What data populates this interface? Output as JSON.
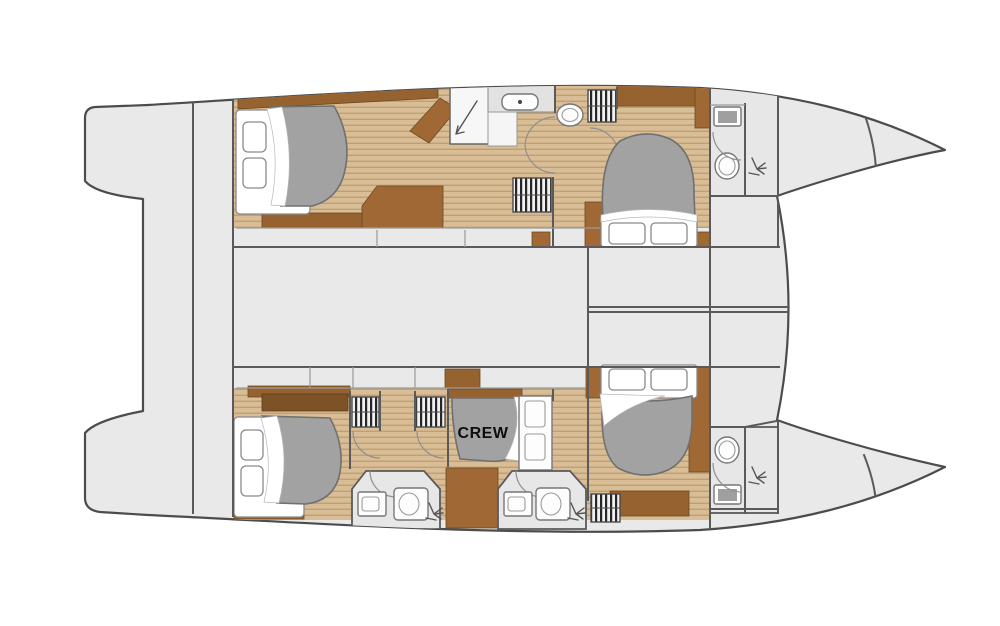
{
  "diagram": {
    "kind": "catamaran-yacht-deck-plan",
    "labels": {
      "crew_cabin": "CREW"
    },
    "colors": {
      "deck_fill": "#e9e9e9",
      "hull_outline": "#4c4c4c",
      "wall": "#5a5a5a",
      "wall_light": "#9a9a9a",
      "teak_base": "#d9bd96",
      "teak_stripe": "#c09f72",
      "wood_brown": "#a06835",
      "wood_brown_dark": "#7e5227",
      "wood_brown_mid": "#96622f",
      "bed_gray": "#a2a2a2",
      "bed_gray_outline": "#707070",
      "bathroom_fill": "#e7e7e7",
      "fixture_outline": "#8a8a8a",
      "label_text": "#0d0d0d"
    }
  }
}
